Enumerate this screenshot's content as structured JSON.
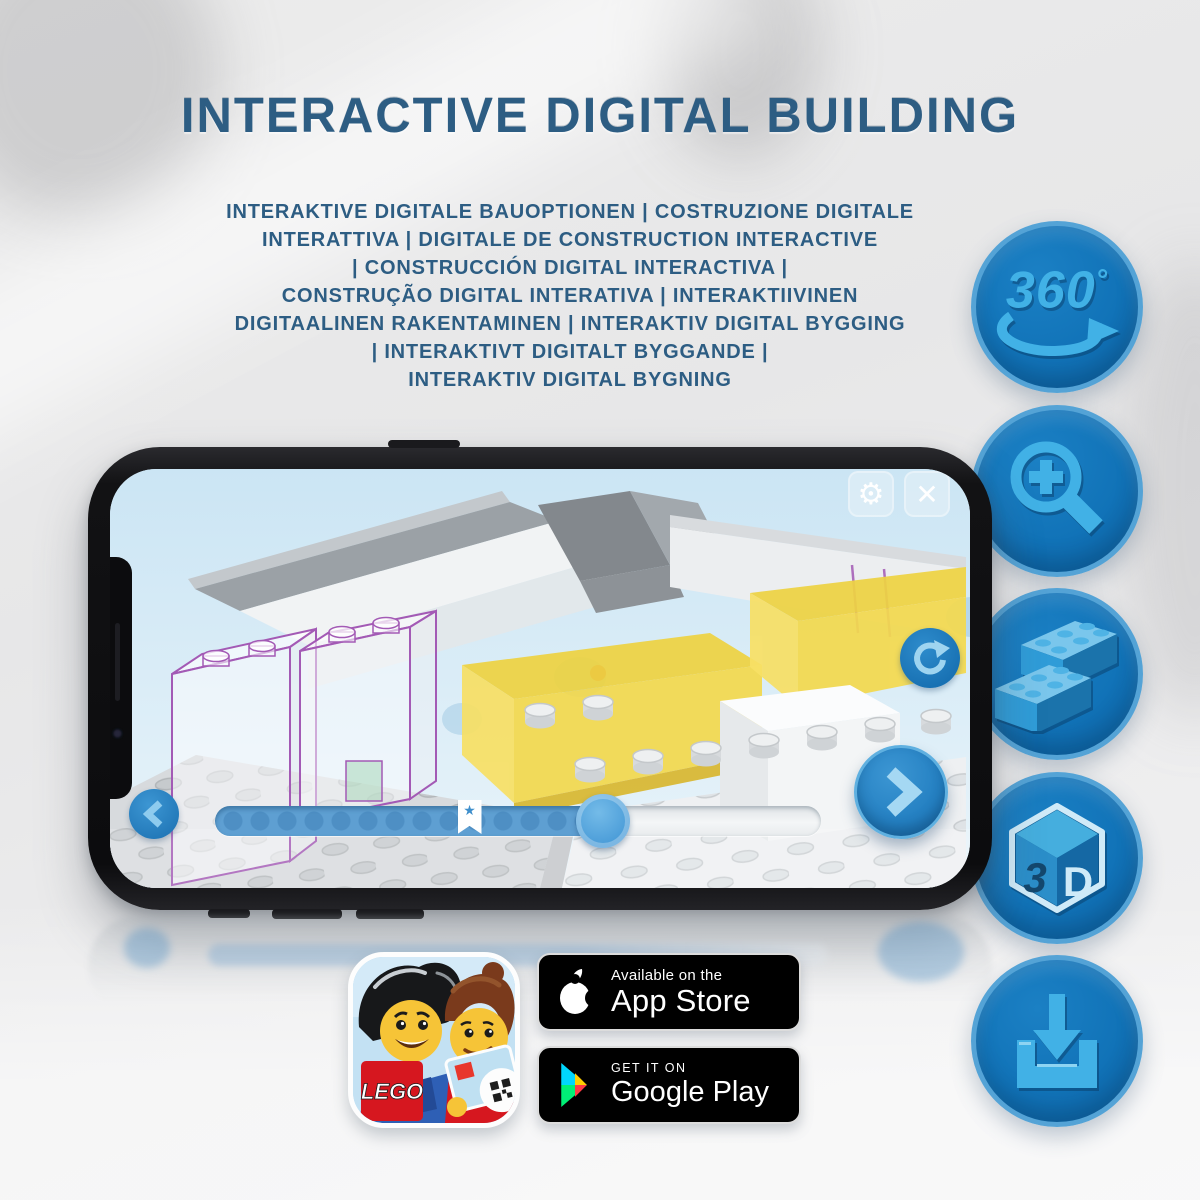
{
  "header": {
    "title": "INTERACTIVE DIGITAL BUILDING",
    "subtitle_lines": [
      "INTERAKTIVE DIGITALE BAUOPTIONEN | COSTRUZIONE DIGITALE",
      "INTERATTIVA | DIGITALE DE CONSTRUCTION INTERACTIVE",
      "| CONSTRUCCIÓN DIGITAL INTERACTIVA |",
      "CONSTRUÇÃO DIGITAL INTERATIVA | INTERAKTIIVINEN",
      "DIGITAALINEN RAKENTAMINEN | INTERAKTIV DIGITAL BYGGING",
      "| INTERAKTIVT DIGITALT BYGGANDE |",
      "INTERAKTIV DIGITAL BYGNING"
    ]
  },
  "features": {
    "rotation_value": "360",
    "rotation_degree": "°",
    "cube_left": "3",
    "cube_right": "D",
    "items": [
      "360-rotation",
      "zoom-in",
      "brick-stacking",
      "3d-view",
      "download"
    ]
  },
  "phone": {
    "app": {
      "settings_glyph": "⚙",
      "close_glyph": "✕",
      "marker_star_glyph": "★"
    },
    "progress_percent": 64,
    "marker_percent": 42
  },
  "badges": {
    "lego_logo": "LEGO",
    "app_store": {
      "tagline": "Available on the",
      "store_name": "App Store"
    },
    "google_play": {
      "tagline": "GET IT ON",
      "store_name": "Google Play"
    }
  },
  "colors": {
    "title_blue": "#2d5d83",
    "icon_circle_blue": "#1173b8",
    "icon_ring_blue": "#54a3d6",
    "icon_glyph_blue": "#41b1e6",
    "ui_button_blue": "#2480c2",
    "screen_sky_blue": "#d5eaf7",
    "lego_red": "#d6171f",
    "ghost_outline_purple": "#a35ab5"
  }
}
